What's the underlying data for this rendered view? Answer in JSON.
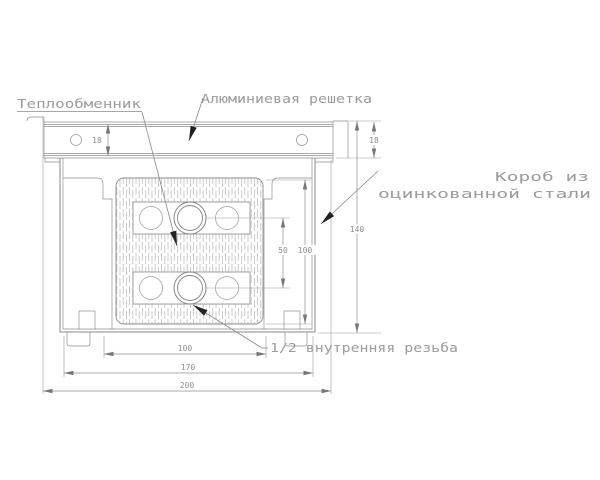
{
  "drawing": {
    "type": "engineering-cross-section",
    "subject": "in-floor convector (heat exchanger in galvanized steel box with aluminum grille)",
    "labels": {
      "heat_exchanger": "Теплообменник",
      "aluminum_grille": "Алюминиевая решетка",
      "steel_box_line1": "Короб из",
      "steel_box_line2": "оцинкованной стали",
      "thread": "1/2 внутренняя резьба"
    },
    "dimensions": {
      "grille_height_left": "18",
      "grille_height_right": "18",
      "overall_height": "140",
      "core_height": "100",
      "pipe_spacing": "50",
      "core_width": "100",
      "box_width": "170",
      "overall_width": "200"
    },
    "colors": {
      "background": "#ffffff",
      "line": "#8a8a8a",
      "extension_line": "#9b9b9b",
      "label_text": "#9b9b9b",
      "dimension_text": "#8f8f8f",
      "leader_arrow": "#222222",
      "dimension_arrow": "#777777",
      "hatch": "#b3b3b3"
    }
  }
}
